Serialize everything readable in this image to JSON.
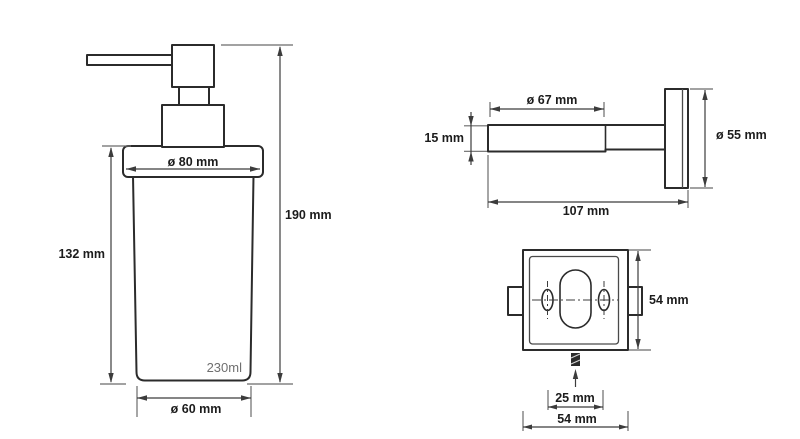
{
  "dispenser": {
    "top_diameter_label": "ø 80 mm",
    "body_height_label": "132 mm",
    "total_height_label": "190 mm",
    "bottom_diameter_label": "ø 60 mm",
    "capacity_label": "230ml"
  },
  "wall_mount_side": {
    "ring_diameter_label": "ø 67 mm",
    "arm_height_label": "15 mm",
    "plate_diameter_label": "ø 55 mm",
    "total_length_label": "107 mm"
  },
  "wall_plate_front": {
    "height_label": "54 mm",
    "hole_spacing_label": "25 mm",
    "width_label": "54 mm"
  },
  "colors": {
    "outline": "#2b2b2b",
    "dimension_line": "#3c3c3c",
    "extension_line": "#6a6a6a",
    "label_text": "#1c1c1c",
    "capacity_text": "#6f6f6f",
    "background": "#ffffff"
  }
}
